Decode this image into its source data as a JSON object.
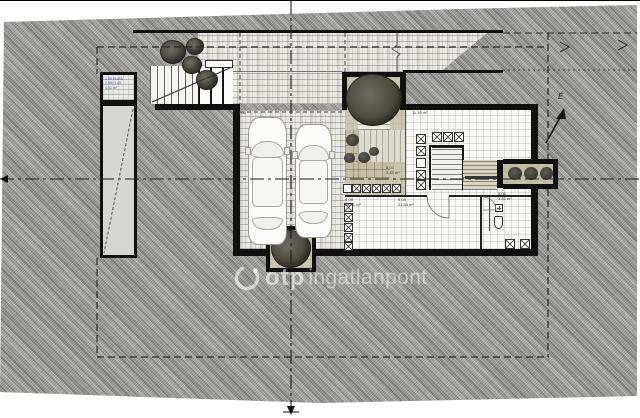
{
  "watermark": {
    "brand": "otp",
    "suffix": "ingatlanpont"
  },
  "compass": {
    "north_label": "É"
  },
  "storage_box": {
    "line1": "1.05 KUKA",
    "line2": "2.00×1.40",
    "line3": "4.51 m²"
  },
  "room_labels": [
    {
      "code": "1.05",
      "area": ""
    },
    {
      "code": "1.11",
      "area": "11.18 m²"
    },
    {
      "code": "8.02",
      "area": "2.48 m²"
    },
    {
      "code": "4.08",
      "area": "38.41 m²"
    },
    {
      "code": "5.04",
      "area": "21.34 m²"
    },
    {
      "code": "5.05",
      "area": "3.85 m²"
    }
  ],
  "colors": {
    "site_hatch": "#a6a6a3",
    "pavement": "#ebe9e4",
    "interior_floor": "#f6f6f3",
    "terrace_beige": "#cbc6af",
    "tree_canopy": "#4a483d",
    "wall_black": "#101010",
    "storage_label_blue": "#3b50a8",
    "watermark_white": "rgba(255,255,255,0.55)"
  }
}
